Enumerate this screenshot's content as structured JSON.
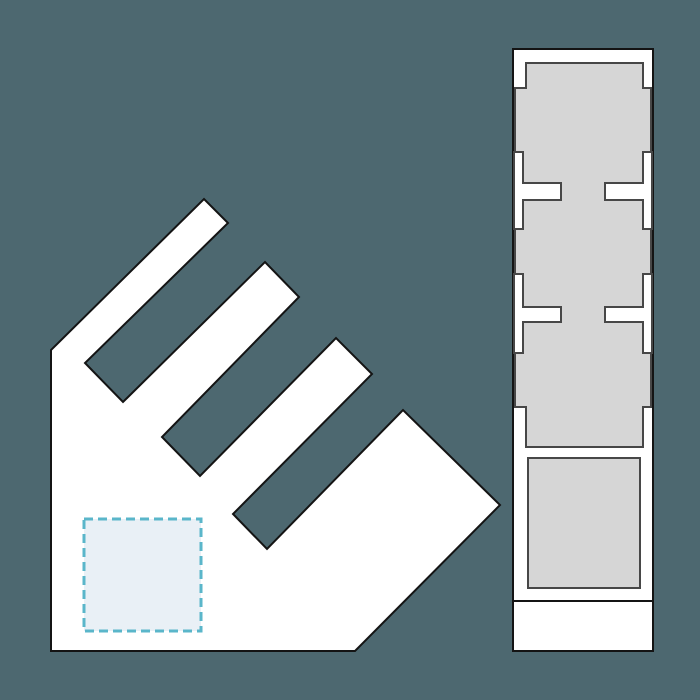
{
  "app": {
    "name": "nesting-layout-canvas"
  },
  "canvas": {
    "width": 700,
    "height": 700,
    "background": "#4d6870",
    "colors": {
      "part_fill": "#ffffff",
      "part_stroke": "#141414",
      "gray_fill": "#d6d6d6",
      "gray_stroke": "#474747",
      "placement_fill": "#e9f0f6",
      "placement_stroke": "#5ab6ca"
    }
  },
  "shapes": [
    {
      "id": "comb-part",
      "type": "polygon",
      "fill": "part_fill",
      "stroke": "part_stroke",
      "stroke_width": 2,
      "points": [
        [
          51,
          651
        ],
        [
          51,
          350
        ],
        [
          204,
          199
        ],
        [
          228,
          223
        ],
        [
          85,
          363
        ],
        [
          123,
          402
        ],
        [
          265,
          262
        ],
        [
          299,
          297
        ],
        [
          162,
          437
        ],
        [
          200,
          476
        ],
        [
          336,
          338
        ],
        [
          372,
          374
        ],
        [
          233,
          514
        ],
        [
          267,
          549
        ],
        [
          403,
          410
        ],
        [
          500,
          505
        ],
        [
          355,
          651
        ]
      ]
    },
    {
      "id": "placement-square",
      "type": "rect",
      "x": 84,
      "y": 519,
      "width": 117,
      "height": 112,
      "fill": "placement_fill",
      "stroke": "placement_stroke",
      "stroke_width": 3,
      "dash": "9,5"
    },
    {
      "id": "column-part",
      "type": "rect",
      "x": 513,
      "y": 49,
      "width": 140,
      "height": 602,
      "fill": "part_fill",
      "stroke": "part_stroke",
      "stroke_width": 2
    },
    {
      "id": "gray-strip-part",
      "type": "polygon",
      "fill": "gray_fill",
      "stroke": "gray_stroke",
      "stroke_width": 2,
      "points": [
        [
          526,
          63
        ],
        [
          643,
          63
        ],
        [
          643,
          88
        ],
        [
          651,
          88
        ],
        [
          651,
          407
        ],
        [
          643,
          407
        ],
        [
          643,
          447
        ],
        [
          526,
          447
        ],
        [
          526,
          407
        ],
        [
          515,
          407
        ],
        [
          515,
          88
        ],
        [
          526,
          88
        ]
      ]
    },
    {
      "id": "t-notch-left-upper",
      "type": "polygon",
      "fill": "part_fill",
      "stroke": "gray_stroke",
      "stroke_width": 2,
      "points": [
        [
          514,
          152
        ],
        [
          523,
          152
        ],
        [
          523,
          183
        ],
        [
          561,
          183
        ],
        [
          561,
          200
        ],
        [
          523,
          200
        ],
        [
          523,
          229
        ],
        [
          514,
          229
        ]
      ]
    },
    {
      "id": "t-notch-right-upper",
      "type": "polygon",
      "fill": "part_fill",
      "stroke": "gray_stroke",
      "stroke_width": 2,
      "points": [
        [
          652,
          152
        ],
        [
          643,
          152
        ],
        [
          643,
          183
        ],
        [
          605,
          183
        ],
        [
          605,
          200
        ],
        [
          643,
          200
        ],
        [
          643,
          229
        ],
        [
          652,
          229
        ]
      ]
    },
    {
      "id": "t-notch-left-lower",
      "type": "polygon",
      "fill": "part_fill",
      "stroke": "gray_stroke",
      "stroke_width": 2,
      "points": [
        [
          514,
          274
        ],
        [
          523,
          274
        ],
        [
          523,
          307
        ],
        [
          561,
          307
        ],
        [
          561,
          322
        ],
        [
          523,
          322
        ],
        [
          523,
          353
        ],
        [
          514,
          353
        ]
      ]
    },
    {
      "id": "t-notch-right-lower",
      "type": "polygon",
      "fill": "part_fill",
      "stroke": "gray_stroke",
      "stroke_width": 2,
      "points": [
        [
          652,
          274
        ],
        [
          643,
          274
        ],
        [
          643,
          307
        ],
        [
          605,
          307
        ],
        [
          605,
          322
        ],
        [
          643,
          322
        ],
        [
          643,
          353
        ],
        [
          652,
          353
        ]
      ]
    },
    {
      "id": "gray-square-part",
      "type": "rect",
      "x": 528,
      "y": 458,
      "width": 112,
      "height": 130,
      "fill": "gray_fill",
      "stroke": "gray_stroke",
      "stroke_width": 2
    },
    {
      "id": "column-divider",
      "type": "line",
      "x1": 513,
      "y1": 601,
      "x2": 653,
      "y2": 601,
      "stroke": "part_stroke",
      "stroke_width": 2
    }
  ]
}
